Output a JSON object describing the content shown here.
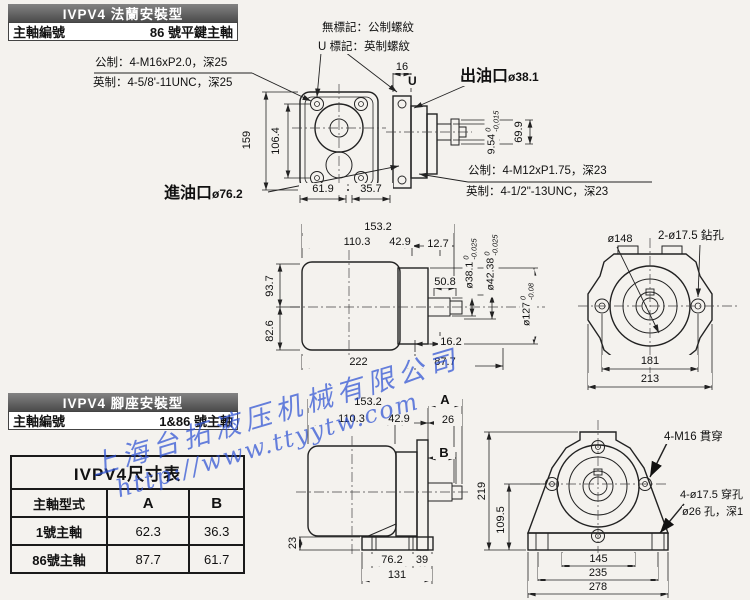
{
  "flange_section": {
    "title": "IVPV4 法蘭安裝型",
    "shaft_label": "主軸編號",
    "shaft_value": "86 號平鍵主軸",
    "note_no_mark": "無標記：公制螺紋",
    "note_u_mark": "U 標記：英制螺紋",
    "u_glyph": "U",
    "note_metric_front": "公制：4-M16xP2.0，深25",
    "note_inch_front": "英制：4-5/8'-11UNC，深25",
    "note_metric_rear": "公制：4-M12xP1.75，深23",
    "note_inch_rear": "英制：4-1/2\"-13UNC，深23",
    "outlet_label": "出油口",
    "outlet_dia": "ø38.1",
    "inlet_label": "進油口",
    "inlet_dia": "ø76.2",
    "dims": {
      "w16": "16",
      "h159": "159",
      "h106_4": "106.4",
      "w61_9": "61.9",
      "w35_7": "35.7",
      "h69_9": "69.9",
      "shaft_dia": "9.54",
      "shaft_tol_hi": "0",
      "shaft_tol_lo": "-0.015"
    }
  },
  "side_view": {
    "dims": {
      "l153_2": "153.2",
      "l110_3": "110.3",
      "l42_9": "42.9",
      "l12_7": "12.7",
      "l50_8": "50.8",
      "h93_7": "93.7",
      "h82_6": "82.6",
      "l16_2": "16.2",
      "l222": "222",
      "l87_7": "87.7"
    },
    "tol_dims": {
      "d38": {
        "main": "ø38.1",
        "hi": "0",
        "lo": "-0.025"
      },
      "d42": {
        "main": "ø42.38",
        "hi": "0",
        "lo": "-0.025"
      },
      "d127": {
        "main": "ø127",
        "hi": "0",
        "lo": "-0.08"
      }
    }
  },
  "end_view": {
    "d148": "ø148",
    "drill": "2-ø17.5 鉆孔",
    "w181": "181",
    "w213": "213"
  },
  "foot_section": {
    "title": "IVPV4 腳座安裝型",
    "shaft_label": "主軸編號",
    "shaft_value": "1&86 號主軸",
    "dims": {
      "l153_2": "153.2",
      "a": "A",
      "l110_3": "110.3",
      "l42_9": "42.9",
      "l26": "26",
      "b": "B",
      "h23": "23",
      "l76_2": "76.2",
      "l39": "39",
      "l131": "131"
    }
  },
  "foot_front": {
    "h219": "219",
    "h109_5": "109.5",
    "m16": "4-M16 貫穿",
    "d17": "4-ø17.5 穿孔",
    "d26": "ø26 孔，深1",
    "w145": "145",
    "w235": "235",
    "w278": "278"
  },
  "size_table": {
    "title": "IVPV4尺寸表",
    "col_type": "主軸型式",
    "col_a": "A",
    "col_b": "B",
    "rows": [
      {
        "type": "1號主軸",
        "a": "62.3",
        "b": "36.3"
      },
      {
        "type": "86號主軸",
        "a": "87.7",
        "b": "61.7"
      }
    ]
  },
  "watermark": {
    "line1": "上海台拓液压机械有限公司",
    "line2": "http://www.ttyytw.com",
    "color": "#2e52d4"
  }
}
